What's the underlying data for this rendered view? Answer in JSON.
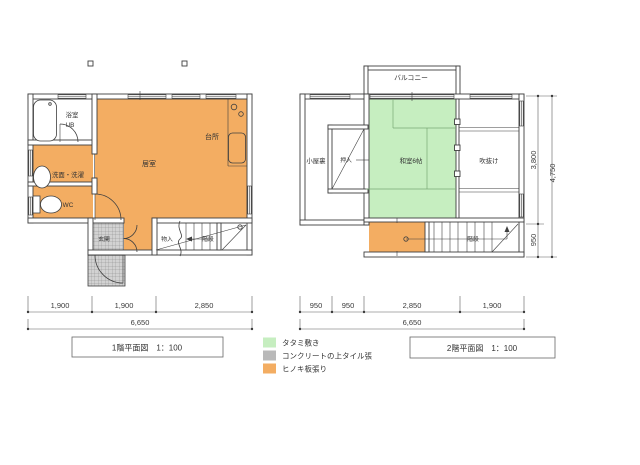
{
  "colors": {
    "hinoki": "#f3ad62",
    "tatami": "#c6eec0",
    "tile_bg": "#d2d2d2",
    "tile_chip": "#b9b9b9",
    "wall": "#3f3f3f",
    "text": "#333333"
  },
  "floor1": {
    "title_name": "1階平面図",
    "title_scale": "1：100",
    "labels": {
      "bath_room": "浴室",
      "bath_ub": "UB",
      "washroom": "洗面・洗濯",
      "wc": "WC",
      "living": "居室",
      "kitchen": "台所",
      "entrance": "玄関",
      "storage": "物入",
      "stairs": "階段"
    },
    "dims": [
      "1,900",
      "1,900",
      "2,850"
    ],
    "dim_total": "6,650"
  },
  "floor2": {
    "title_name": "2階平面図",
    "title_scale": "1：100",
    "labels": {
      "balcony": "バルコニー",
      "attic": "小屋裏",
      "closet": "押入",
      "washitsu": "和室6帖",
      "void": "吹抜け",
      "stairs": "階段"
    },
    "dims": [
      "950",
      "950",
      "2,850",
      "1,900"
    ],
    "dim_total": "6,650",
    "right_dims": {
      "upper": "3,800",
      "lower": "950",
      "total": "4,750"
    }
  },
  "legend": {
    "items": [
      {
        "color": "#c6eec0",
        "label": "タタミ敷き"
      },
      {
        "color": "#b9b9b9",
        "label": "コンクリートの上タイル張"
      },
      {
        "color": "#f3ad62",
        "label": "ヒノキ板張り"
      }
    ]
  }
}
